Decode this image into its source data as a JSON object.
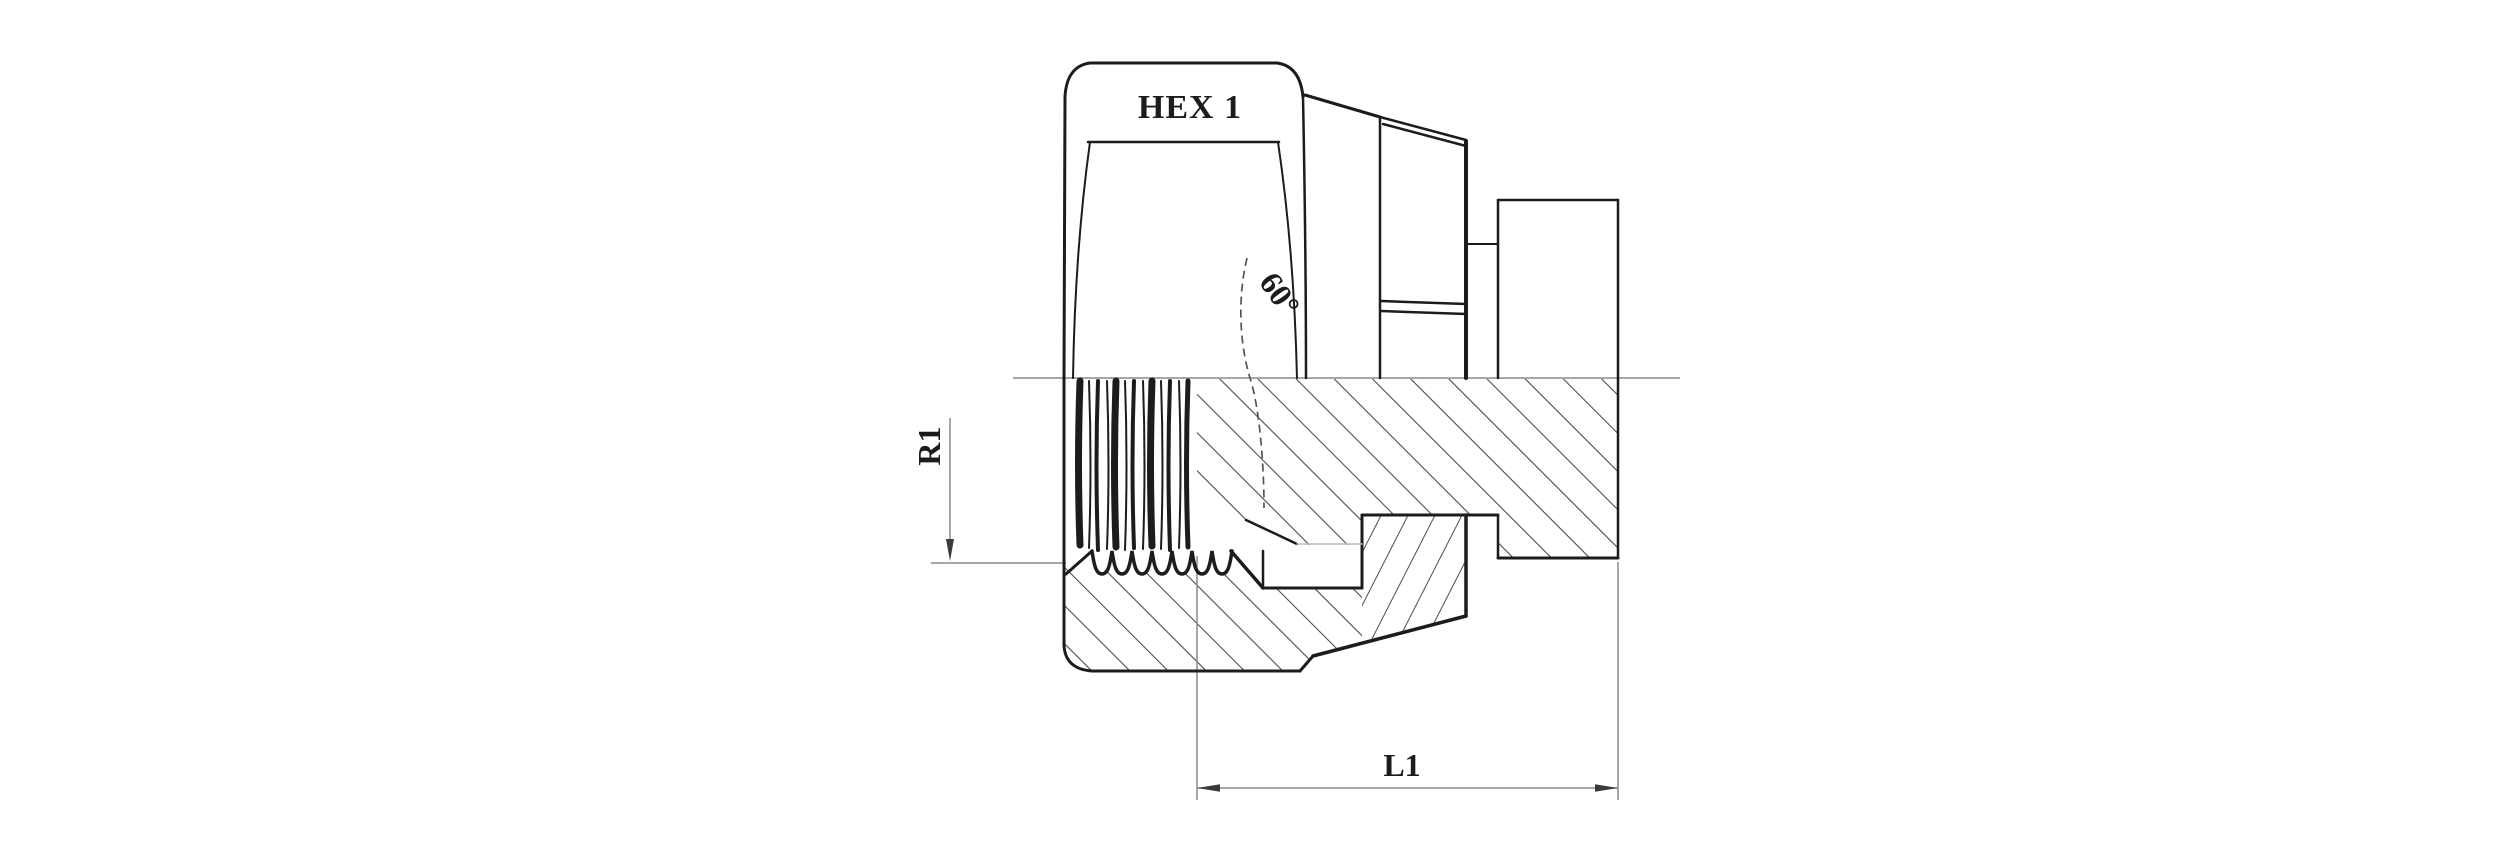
{
  "drawing": {
    "hex_label": "HEX 1",
    "angle_label": "60°",
    "radius_label": "R1",
    "length_label": "L1"
  },
  "colors": {
    "background": "#ffffff",
    "line": "#1c1c1c",
    "hatch": "#4d4d4d",
    "dimension": "#8a8a8a",
    "faint": "#bcbcbc"
  }
}
